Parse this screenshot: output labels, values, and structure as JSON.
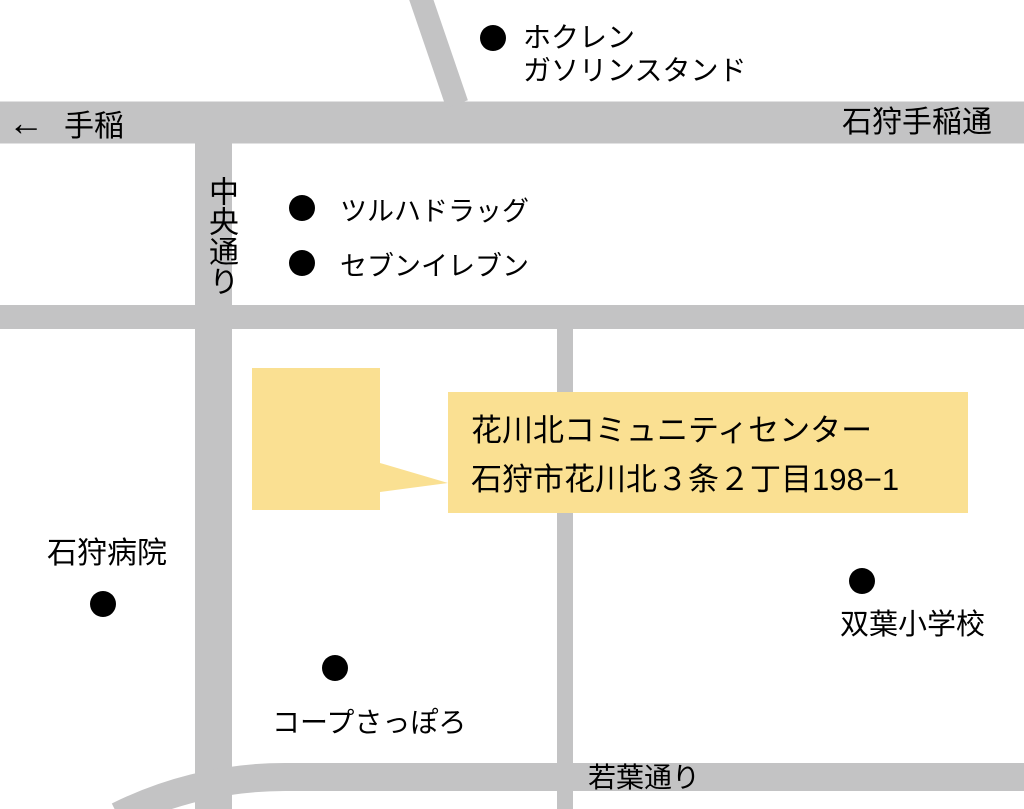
{
  "colors": {
    "background": "#FFFFFF",
    "road": "#C3C3C4",
    "highlight": "#FAE092",
    "dot": "#000000",
    "text": "#000000"
  },
  "roads": {
    "teine_arrow": "←",
    "teine_label": "手稲",
    "ishikari_teine_label": "石狩手稲通",
    "chuo_label": "中央通り",
    "wakaba_label": "若葉通り"
  },
  "landmarks": {
    "hokuren": {
      "line1": "ホクレン",
      "line2": "ガソリンスタンド"
    },
    "tsuruha": {
      "label": "ツルハドラッグ"
    },
    "seven_eleven": {
      "label": "セブンイレブン"
    },
    "ishikari_hospital": {
      "label": "石狩病院"
    },
    "coop_sapporo": {
      "label": "コープさっぽろ"
    },
    "futaba_school": {
      "label": "双葉小学校"
    }
  },
  "callout": {
    "title": "花川北コミュニティセンター",
    "address": "石狩市花川北３条２丁目198−1"
  }
}
